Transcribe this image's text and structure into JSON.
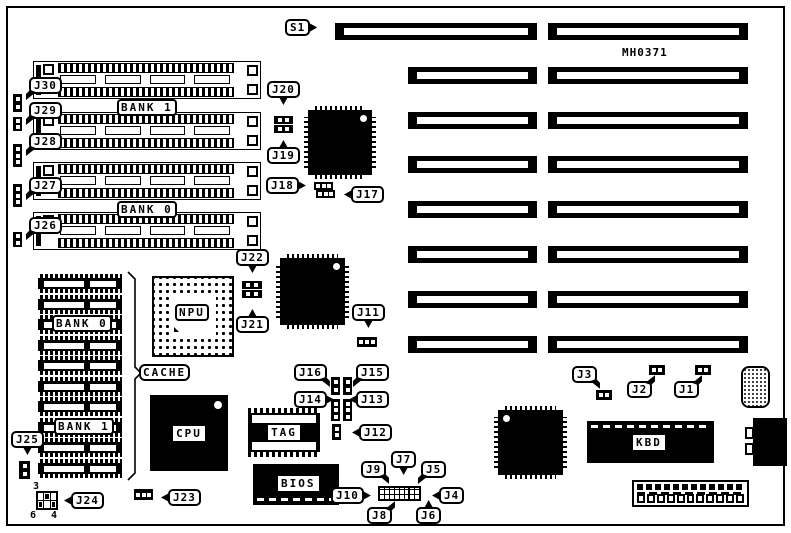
{
  "board": {
    "code": "MH0371"
  },
  "chip_labels": {
    "bank1_simm": "BANK 1",
    "bank0_simm": "BANK 0",
    "bank0_cache": "BANK 0",
    "bank1_cache": "BANK 1",
    "cache": "CACHE",
    "npu": "NPU",
    "cpu": "CPU",
    "tag": "TAG",
    "bios": "BIOS",
    "kbd": "KBD"
  },
  "pin_numbers": {
    "j24_pin3": "3",
    "j24_pin6": "6",
    "j24_pin4": "4"
  },
  "callouts": [
    {
      "label": "S1",
      "x": 285,
      "y": 19,
      "tail": "right"
    },
    {
      "label": "J30",
      "x": 29,
      "y": 77,
      "tail": "down-left"
    },
    {
      "label": "J29",
      "x": 29,
      "y": 102,
      "tail": "down-left"
    },
    {
      "label": "J28",
      "x": 29,
      "y": 133,
      "tail": "down-left"
    },
    {
      "label": "J27",
      "x": 29,
      "y": 177,
      "tail": "down-left"
    },
    {
      "label": "J26",
      "x": 29,
      "y": 217,
      "tail": "down-left"
    },
    {
      "label": "J20",
      "x": 267,
      "y": 81,
      "tail": "down"
    },
    {
      "label": "J19",
      "x": 267,
      "y": 147,
      "tail": "up"
    },
    {
      "label": "J18",
      "x": 266,
      "y": 177,
      "tail": "right"
    },
    {
      "label": "J17",
      "x": 351,
      "y": 186,
      "tail": "left"
    },
    {
      "label": "J22",
      "x": 236,
      "y": 249,
      "tail": "down"
    },
    {
      "label": "J21",
      "x": 236,
      "y": 316,
      "tail": "up"
    },
    {
      "label": "J11",
      "x": 352,
      "y": 304,
      "tail": "down"
    },
    {
      "label": "J16",
      "x": 294,
      "y": 364,
      "tail": "down-right"
    },
    {
      "label": "J15",
      "x": 356,
      "y": 364,
      "tail": "down-left"
    },
    {
      "label": "J14",
      "x": 294,
      "y": 391,
      "tail": "right"
    },
    {
      "label": "J13",
      "x": 356,
      "y": 391,
      "tail": "left"
    },
    {
      "label": "J12",
      "x": 359,
      "y": 424,
      "tail": "left"
    },
    {
      "label": "J9",
      "x": 361,
      "y": 461,
      "tail": "down-right"
    },
    {
      "label": "J7",
      "x": 391,
      "y": 451,
      "tail": "down"
    },
    {
      "label": "J5",
      "x": 421,
      "y": 461,
      "tail": "down-left"
    },
    {
      "label": "J10",
      "x": 331,
      "y": 487,
      "tail": "right"
    },
    {
      "label": "J4",
      "x": 439,
      "y": 487,
      "tail": "left"
    },
    {
      "label": "J8",
      "x": 367,
      "y": 507,
      "tail": "up-right"
    },
    {
      "label": "J6",
      "x": 416,
      "y": 507,
      "tail": "up"
    },
    {
      "label": "J3",
      "x": 572,
      "y": 366,
      "tail": "down-right"
    },
    {
      "label": "J2",
      "x": 627,
      "y": 381,
      "tail": "up-right"
    },
    {
      "label": "J1",
      "x": 674,
      "y": 381,
      "tail": "up-right"
    },
    {
      "label": "J25",
      "x": 11,
      "y": 431,
      "tail": "down"
    },
    {
      "label": "J24",
      "x": 71,
      "y": 492,
      "tail": "left"
    },
    {
      "label": "J23",
      "x": 168,
      "y": 489,
      "tail": "left"
    }
  ]
}
